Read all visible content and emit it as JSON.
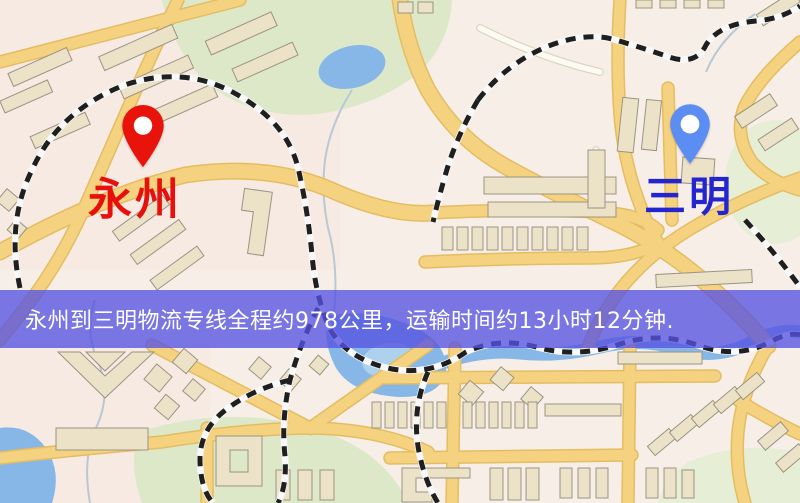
{
  "map": {
    "origin": {
      "name": "永州",
      "label_color": "#e8100c",
      "pin_color": "#e8140c"
    },
    "destination": {
      "name": "三明",
      "label_color": "#2326d0",
      "pin_color": "#5b8df2"
    },
    "banner": {
      "text": "永州到三明物流专线全程约978公里，运输时间约13小时12分钟.",
      "bg_color": "#5652e0",
      "text_color": "#ffffff"
    },
    "route": {
      "from": "永州",
      "to": "三明",
      "distance_text": "约978公里",
      "duration_text": "约13小时12分钟"
    },
    "palette": {
      "background": "#f7efe7",
      "road": "#f5d280",
      "road_casing": "#e4bd62",
      "water": "#86b7e6",
      "park": "#dde8c8",
      "building": "#ebe2c7",
      "railway_dark": "#1f1f1f",
      "railway_light": "#f8f8f8"
    }
  }
}
